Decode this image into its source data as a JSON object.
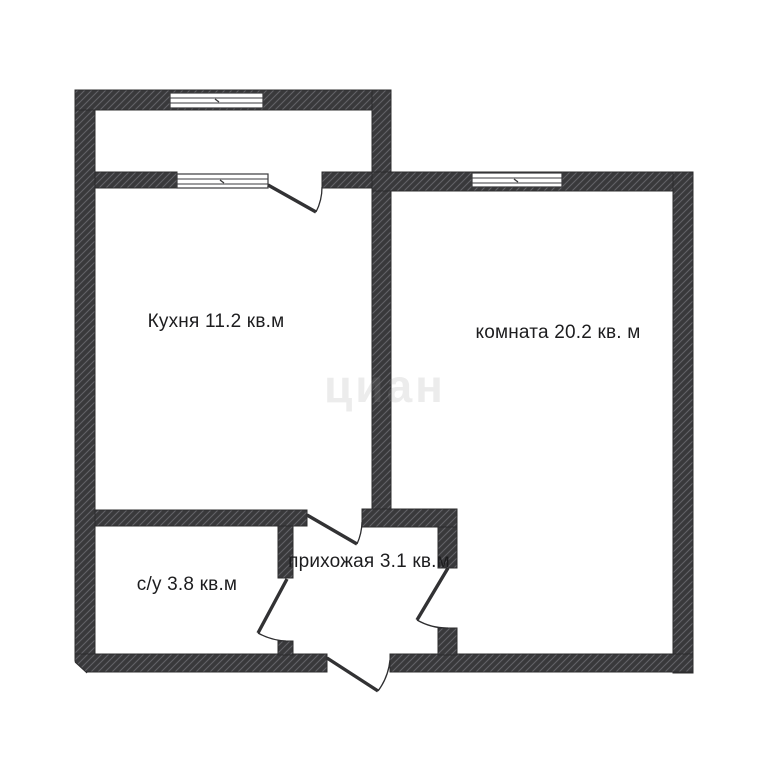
{
  "floorplan": {
    "type": "apartment-floor-plan",
    "rooms": [
      {
        "key": "kitchen",
        "label": "Кухня 11.2 кв.м"
      },
      {
        "key": "room",
        "label": "комната 20.2 кв. м"
      },
      {
        "key": "bathroom",
        "label": "с/у 3.8 кв.м"
      },
      {
        "key": "hallway",
        "label": "прихожая 3.1 кв.м"
      }
    ],
    "watermark": "циан",
    "counts": {
      "windows": "3",
      "doors": "5"
    },
    "colors": {
      "wall_fill": "#39393b",
      "wall_hatch": "#626266",
      "wall_outline": "#2c2c2e",
      "door_line": "#2e2e30",
      "window_fill": "#ffffff",
      "label_text": "#1d1d1f",
      "background": "#ffffff"
    }
  }
}
